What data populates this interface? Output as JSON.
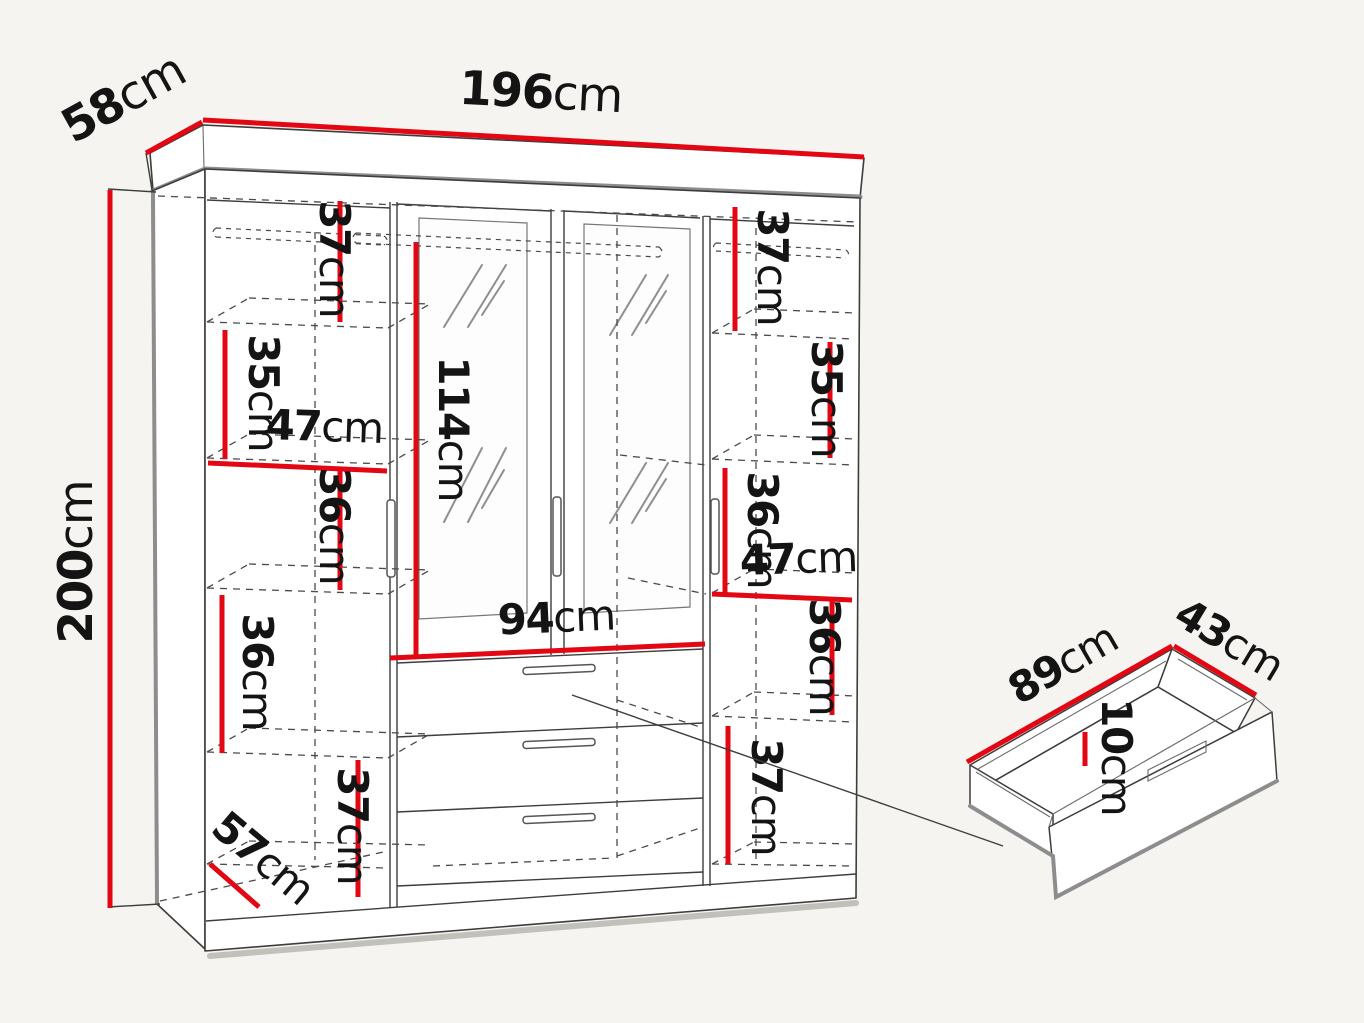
{
  "diagram": {
    "type": "furniture-dimension-diagram",
    "subject": "four-door mirrored wardrobe with three drawers, plus detached drawer detail",
    "unit": "cm",
    "colors": {
      "dimension_red": "#e30613",
      "outline_dark": "#3d3d3d",
      "edge_gray": "#8d8d8d",
      "background": "#f5f4f1",
      "text": "#141414"
    },
    "wardrobe": {
      "overall": {
        "width": {
          "value": "196",
          "unit": "cm"
        },
        "depth": {
          "value": "58",
          "unit": "cm"
        },
        "height": {
          "value": "200",
          "unit": "cm"
        }
      },
      "left_column": {
        "shelf_top": {
          "value": "37",
          "unit": "cm"
        },
        "shelf_second": {
          "value": "35",
          "unit": "cm"
        },
        "inner_width": {
          "value": "47",
          "unit": "cm"
        },
        "shelf_third": {
          "value": "36",
          "unit": "cm"
        },
        "shelf_fourth": {
          "value": "36",
          "unit": "cm"
        },
        "inner_depth": {
          "value": "57",
          "unit": "cm"
        },
        "shelf_bottom": {
          "value": "37",
          "unit": "cm"
        }
      },
      "center_section": {
        "mirror_door_height": {
          "value": "114",
          "unit": "cm"
        },
        "inner_width": {
          "value": "94",
          "unit": "cm"
        }
      },
      "right_column": {
        "shelf_top": {
          "value": "37",
          "unit": "cm"
        },
        "shelf_second": {
          "value": "35",
          "unit": "cm"
        },
        "shelf_third": {
          "value": "36",
          "unit": "cm"
        },
        "inner_width": {
          "value": "47",
          "unit": "cm"
        },
        "shelf_fourth": {
          "value": "36",
          "unit": "cm"
        },
        "shelf_bottom": {
          "value": "37",
          "unit": "cm"
        }
      }
    },
    "drawer_detail": {
      "width": {
        "value": "89",
        "unit": "cm"
      },
      "depth": {
        "value": "43",
        "unit": "cm"
      },
      "height": {
        "value": "10",
        "unit": "cm"
      }
    }
  }
}
